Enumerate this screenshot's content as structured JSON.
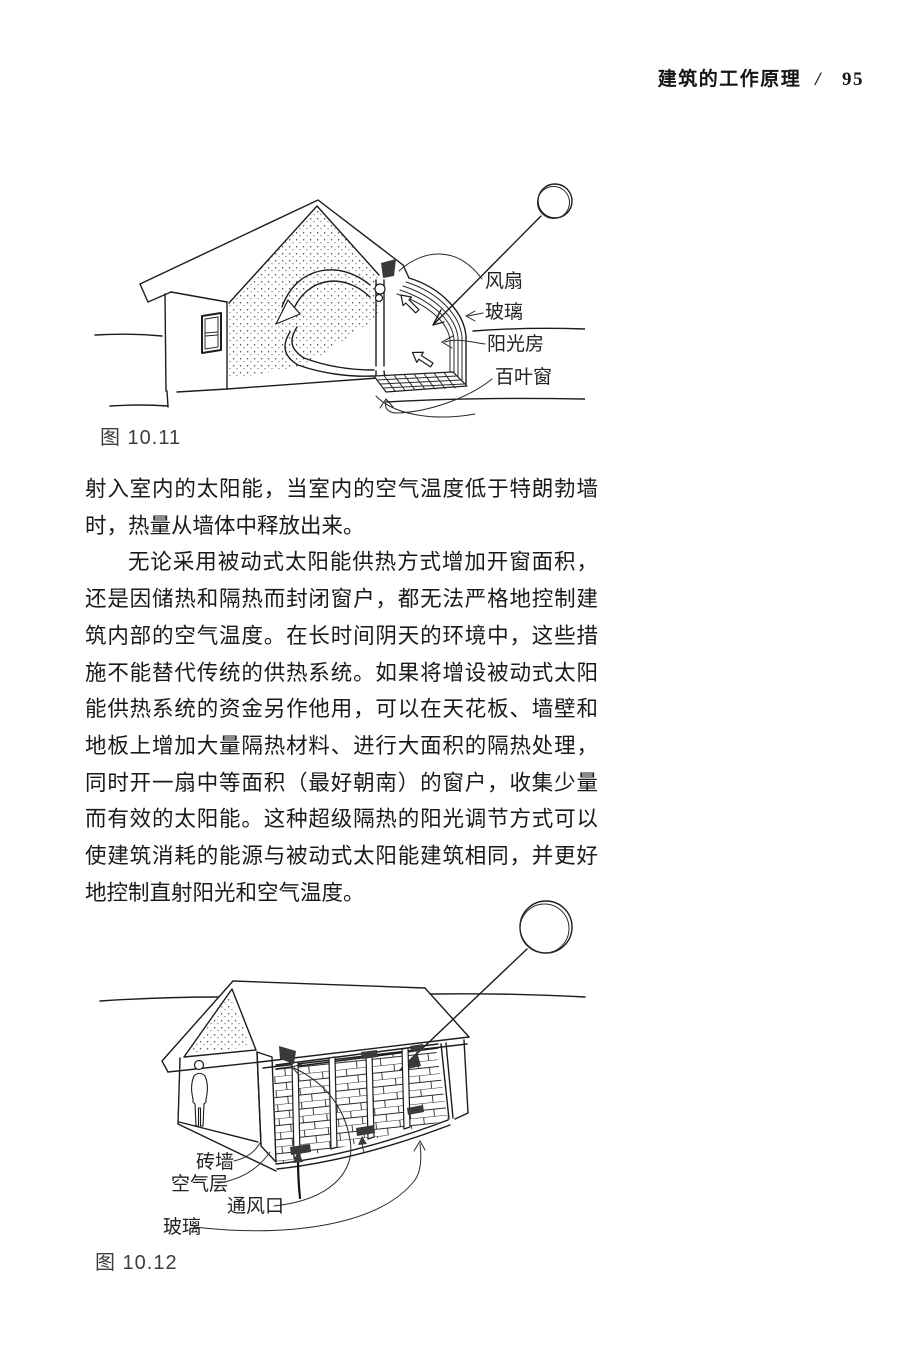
{
  "header": {
    "running_title": "建筑的工作原理",
    "separator": "/",
    "page_number": "95"
  },
  "body": {
    "paragraph1": "射入室内的太阳能，当室内的空气温度低于特朗勃墙时，热量从墙体中释放出来。",
    "paragraph2": "无论采用被动式太阳能供热方式增加开窗面积，还是因储热和隔热而封闭窗户，都无法严格地控制建筑内部的空气温度。在长时间阴天的环境中，这些措施不能替代传统的供热系统。如果将增设被动式太阳能供热系统的资金另作他用，可以在天花板、墙壁和地板上增加大量隔热材料、进行大面积的隔热处理，同时开一扇中等面积（最好朝南）的窗户，收集少量而有效的太阳能。这种超级隔热的阳光调节方式可以使建筑消耗的能源与被动式太阳能建筑相同，并更好地控制直射阳光和空气温度。"
  },
  "figures": {
    "fig1": {
      "caption": "图 10.11",
      "labels": {
        "fan": "风扇",
        "glass": "玻璃",
        "sunroom": "阳光房",
        "louver": "百叶窗"
      }
    },
    "fig2": {
      "caption": "图 10.12",
      "labels": {
        "brick_wall": "砖墙",
        "air_layer": "空气层",
        "vent": "通风口",
        "glass": "玻璃"
      }
    }
  }
}
